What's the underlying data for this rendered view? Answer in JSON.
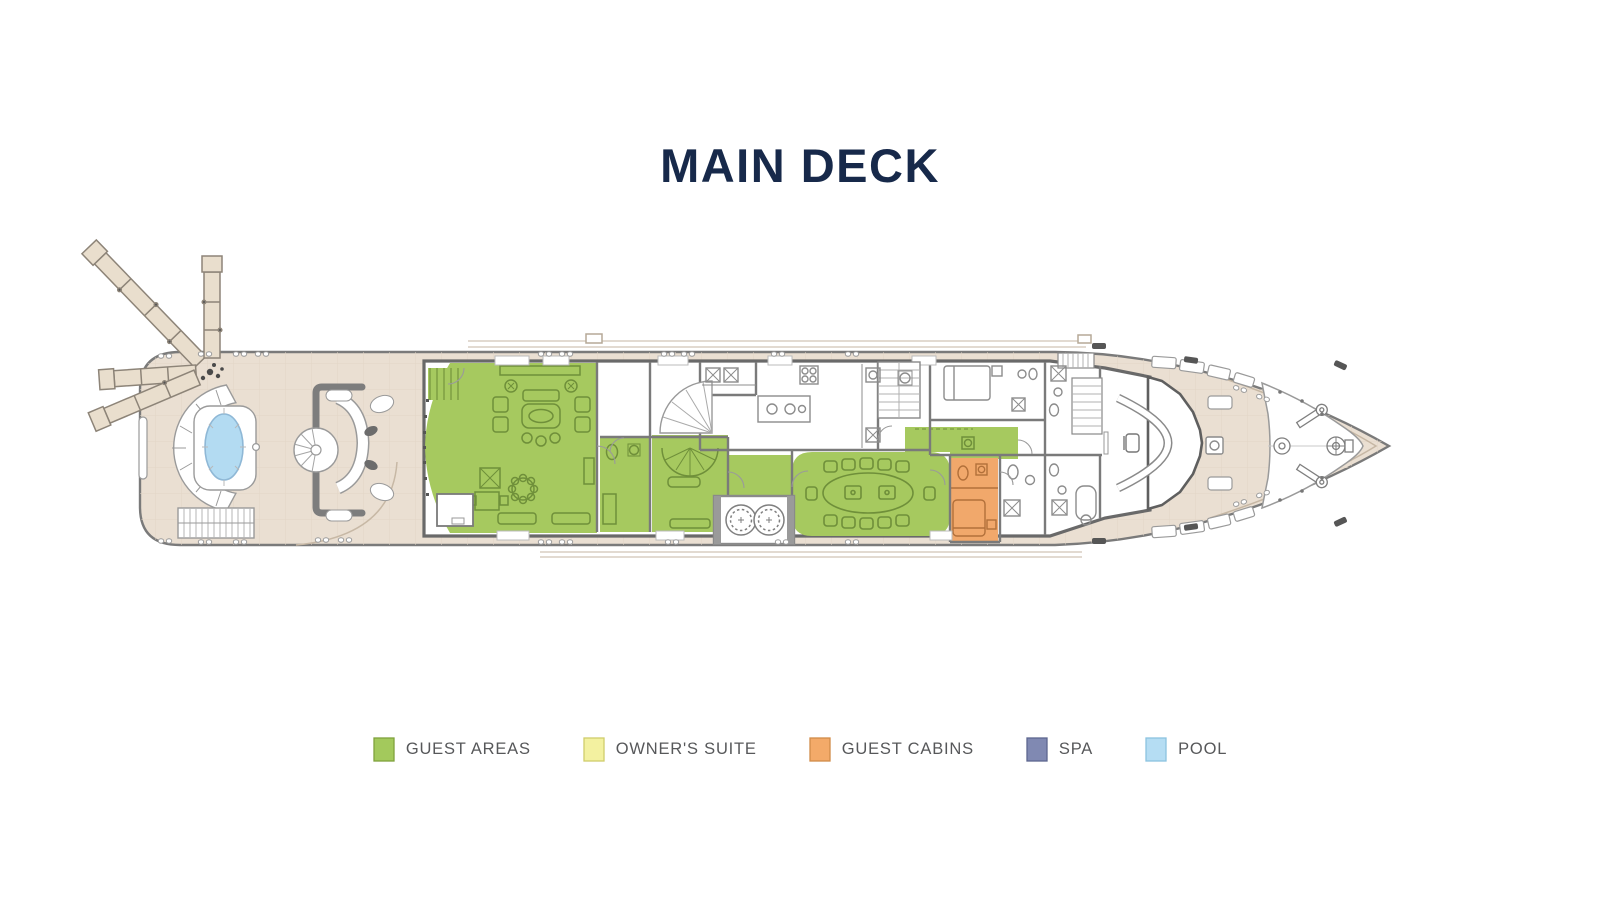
{
  "header": {
    "title": "MAIN DECK",
    "title_color": "#17294a"
  },
  "legend": {
    "label_color": "#57585a",
    "items": [
      {
        "label": "GUEST AREAS",
        "color": "#a3c95c",
        "border": "#7fa23c"
      },
      {
        "label": "OWNER'S SUITE",
        "color": "#f3f1a0",
        "border": "#cfcd6b"
      },
      {
        "label": "GUEST CABINS",
        "color": "#f3aa69",
        "border": "#d18c49"
      },
      {
        "label": "SPA",
        "color": "#8089b2",
        "border": "#5d668f"
      },
      {
        "label": "POOL",
        "color": "#b5ddf3",
        "border": "#8cc3e0"
      }
    ]
  },
  "plan": {
    "colors": {
      "hull": "#eadfd2",
      "hull_line": "#7a7a7a",
      "deck_grid": "#e2d5c6",
      "gangway": "#e9decd",
      "wall": "#696969",
      "thin_wall": "#7a7a7a",
      "room": "#ffffff",
      "guest_areas": "#a6c95f",
      "guest_cabins": "#f1a86b",
      "pool": "#b3dbf2",
      "furniture_green": "#6f8f3a",
      "furniture_gray": "#8c8c8c",
      "faint_line": "#d9cec2"
    }
  }
}
